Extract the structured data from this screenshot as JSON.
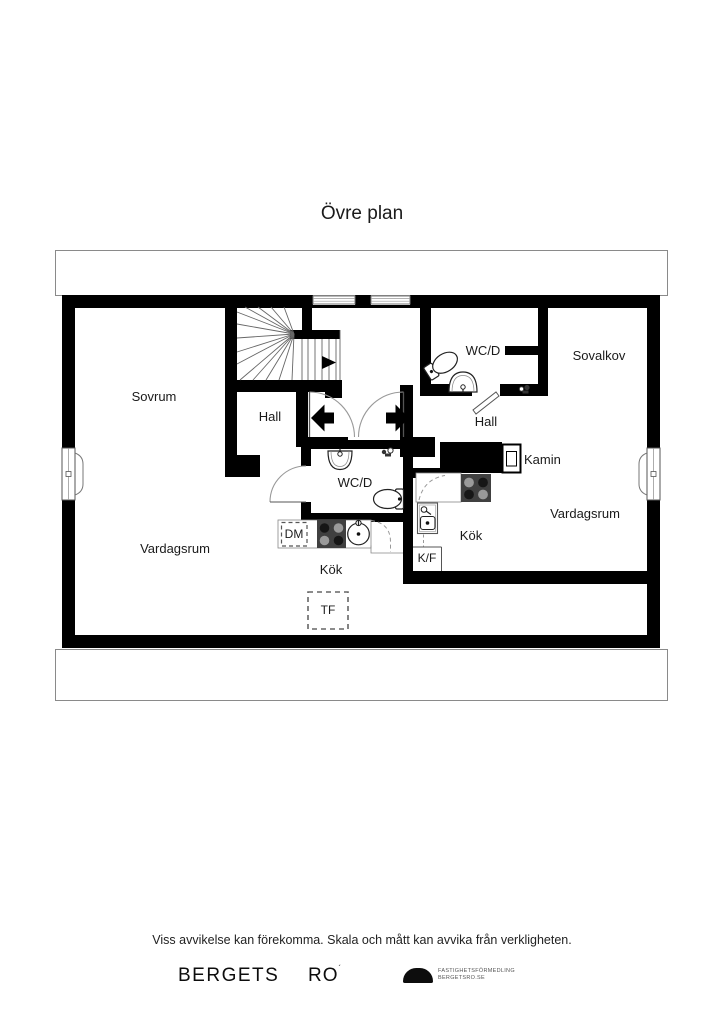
{
  "title": "Övre plan",
  "rooms": {
    "sovrum": "Sovrum",
    "hall_left": "Hall",
    "wcd_top": "WC/D",
    "sovalkov": "Sovalkov",
    "hall_right": "Hall",
    "kamin": "Kamin",
    "vardagsrum_right": "Vardagsrum",
    "wcd_center": "WC/D",
    "dm": "DM",
    "kok_center": "Kök",
    "kf": "K/F",
    "kok_right": "Kök",
    "vardagsrum_left": "Vardagsrum",
    "tf": "TF"
  },
  "footer": {
    "disclaimer": "Viss avvikelse kan förekomma. Skala och mått kan avvika från verkligheten.",
    "brand_bergets": "BERGETS",
    "brand_ro": "RO",
    "brand_ro_mark": "´",
    "agency_line1": "FASTIGHETSFÖRMEDLING",
    "agency_line2": "BERGETSRO.SE"
  },
  "icons": {
    "stairs": "stairs-icon",
    "entry_arrow_left": "arrow-left-icon",
    "entry_arrow_right": "arrow-right-icon",
    "stair_direction": "arrow-right-icon",
    "toilet": "toilet-icon",
    "sink": "sink-icon",
    "stove": "stove-icon",
    "dishwasher": "dishwasher-box",
    "fridge_freezer": "fridge-freezer-nook",
    "fireplace": "fireplace-icon",
    "window": "window-icon",
    "door": "door-arc-icon",
    "logo": "dome-logo-icon"
  },
  "colors": {
    "wall": "#000000",
    "appliance_dark": "#404040",
    "burner_light": "#9a9a9a",
    "burner_dark": "#161616",
    "thin_line": "#555555",
    "band_border": "#8a8a8a"
  }
}
